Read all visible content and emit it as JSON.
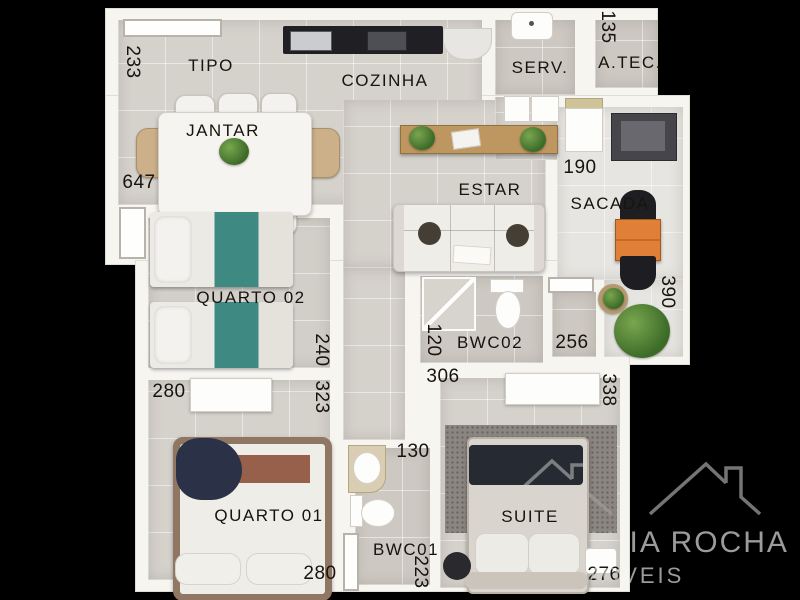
{
  "plan_title": "apartment-floor-plan",
  "rooms": {
    "tipo": "TIPO",
    "cozinha": "COZINHA",
    "serv": "SERV.",
    "atec": "A.TEC.",
    "jantar": "JANTAR",
    "estar": "ESTAR",
    "sacada": "SACADA",
    "quarto02": "QUARTO 02",
    "bwc02": "BWC02",
    "quarto01": "QUARTO 01",
    "bwc01": "BWC01",
    "suite": "SUITE"
  },
  "dimensions_cm": {
    "left_upper": "233",
    "tech_area": "135",
    "left_main": "647",
    "balcony_top": "190",
    "balcony_side": "390",
    "bedroom2_side": "240",
    "bedroom1_top": "280",
    "bedroom1_side": "323",
    "suite_top": "306",
    "bwc2_side": "120",
    "deposit": "256",
    "suite_side": "338",
    "bwc1_top": "130",
    "bwc1_side": "223",
    "bedroom1_bottom": "280",
    "suite_bottom": "276"
  },
  "watermark": {
    "line1": "MARIVANIA ROCHA",
    "line2": "IMÓVEIS",
    "logo": "house-roofs-logo"
  },
  "colors": {
    "background": "#000000",
    "wall": "#f7f5f0",
    "floor_main": "#d5d1cb",
    "floor_balcony": "#e7e5e1",
    "bed_teal": "#3e8a82",
    "balcony_table_orange": "#e08036",
    "counter_dark": "#202024",
    "wood_sideboard": "#bd9660",
    "watermark_gray": "#9b9b9b",
    "label_text": "#17140f"
  }
}
